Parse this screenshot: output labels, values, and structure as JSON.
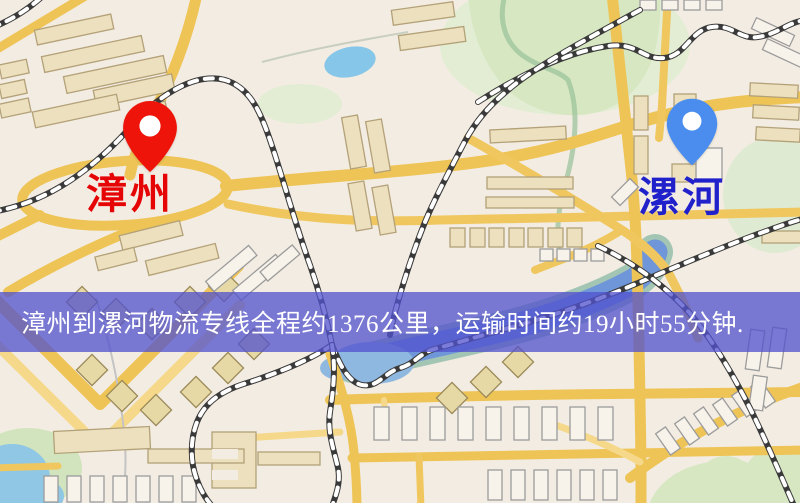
{
  "page": {
    "width": 800,
    "height": 503,
    "kind": "logistics route map image"
  },
  "map": {
    "origin": {
      "name": "漳州",
      "pin_color": "#ee1409",
      "pin_hole_color": "#ffffff",
      "label_color": "#e60505"
    },
    "destination": {
      "name": "漯河",
      "pin_color": "#4a8dee",
      "pin_hole_color": "#ffffff",
      "label_color": "#2121cb"
    },
    "banner": {
      "text": "漳州到漯河物流专线全程约1376公里，运输时间约19小时55分钟.",
      "background_color": "#5252cd",
      "opacity": 0.76,
      "text_color": "#ffffff"
    },
    "route": {
      "origin_city": "漳州",
      "destination_city": "漯河",
      "service": "物流专线",
      "distance_km": "1376",
      "duration": "19小时55分钟"
    },
    "palette": {
      "background": "#f3ece2",
      "road_main": "#eec457",
      "road_light": "#f5d88a",
      "park": "#d6e7c2",
      "water": "#86c6e8",
      "river": "#6f96d8",
      "building_tan": "#ede0be",
      "building_white": "#f7f3ea",
      "railway": "#3a3a3a"
    }
  }
}
